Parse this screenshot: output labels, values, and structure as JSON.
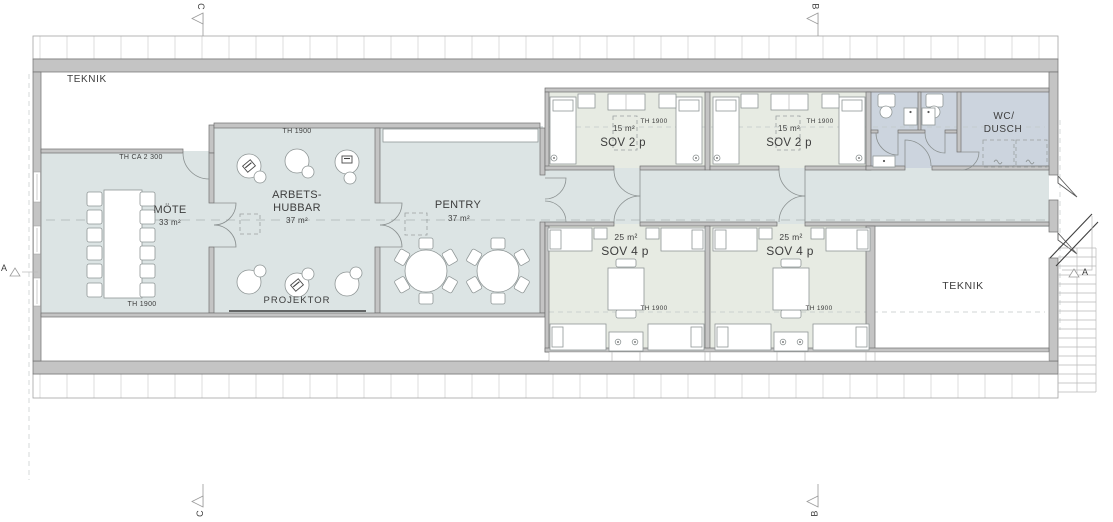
{
  "palette": {
    "room_blue": "#dce4e4",
    "bedroom_green": "#e7ebe3",
    "wc_blue": "#ccd4de",
    "wall_fill": "#c4c4c4",
    "wall_stroke": "#6f6f6f",
    "furniture_stroke": "#8f9696",
    "dash_color": "#b7bfbf",
    "text_color": "#3d3d3d",
    "hatch_line": "#dcdcdc",
    "band_stroke": "#a3a3a3"
  },
  "rooms": {
    "teknik_top": {
      "name": "TEKNIK"
    },
    "mote": {
      "name": "MÖTE",
      "area": "33 m²"
    },
    "arbetshubbar": {
      "name_line1": "ARBETS-",
      "name_line2": "HUBBAR",
      "area": "37 m²"
    },
    "pentry": {
      "name": "PENTRY",
      "area": "37 m²"
    },
    "sov2p_left": {
      "name": "SOV 2 p",
      "area": "15 m²"
    },
    "sov2p_right": {
      "name": "SOV 2 p",
      "area": "15 m²"
    },
    "wc_dusch": {
      "name_line1": "WC/",
      "name_line2": "DUSCH"
    },
    "sov4p_left": {
      "name": "SOV 4 p",
      "area": "25 m²"
    },
    "sov4p_right": {
      "name": "SOV 4 p",
      "area": "25 m²"
    },
    "teknik_bottom": {
      "name": "TEKNIK"
    }
  },
  "annotations": {
    "ceiling_height_main": "TH CA 2 300",
    "ceiling_height": "TH 1900",
    "projector": "PROJEKTOR"
  },
  "section_markers": {
    "a": "A",
    "b": "B",
    "c": "C"
  }
}
